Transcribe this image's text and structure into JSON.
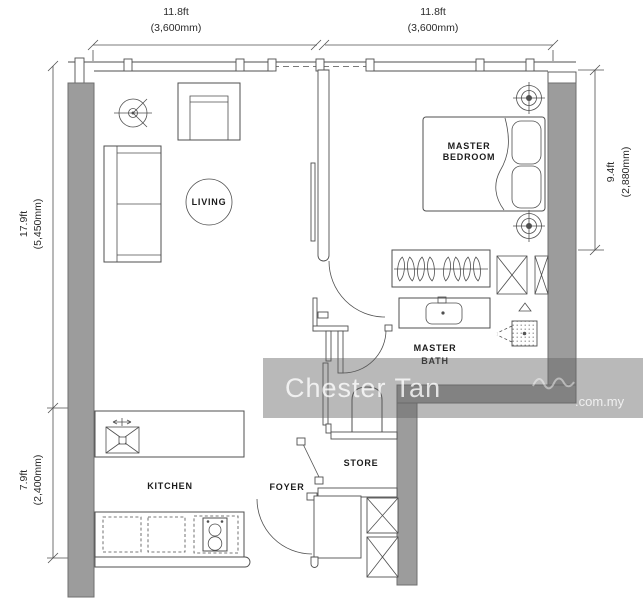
{
  "dimensions": {
    "top_left": {
      "ft": "11.8ft",
      "mm": "(3,600mm)"
    },
    "top_right": {
      "ft": "11.8ft",
      "mm": "(3,600mm)"
    },
    "left_upper": {
      "ft": "17.9ft",
      "mm": "(5,450mm)"
    },
    "left_lower": {
      "ft": "7.9ft",
      "mm": "(2,400mm)"
    },
    "right": {
      "ft": "9.4ft",
      "mm": "(2,880mm)"
    }
  },
  "rooms": {
    "living": "LIVING",
    "master_bedroom_line1": "MASTER",
    "master_bedroom_line2": "BEDROOM",
    "master_bath_line1": "MASTER",
    "master_bath_line2": "BATH",
    "kitchen": "KITCHEN",
    "foyer": "FOYER",
    "store": "STORE"
  },
  "watermark": {
    "name": "Chester Tan",
    "domain": ".com.my"
  },
  "colors": {
    "wall_fill": "#9c9c9c",
    "wall_edge": "#6f6f6f",
    "line_color": "#4f4f4f",
    "band_color": "rgba(100,100,100,0.45)",
    "wm_text": "rgba(255,255,255,0.78)"
  }
}
